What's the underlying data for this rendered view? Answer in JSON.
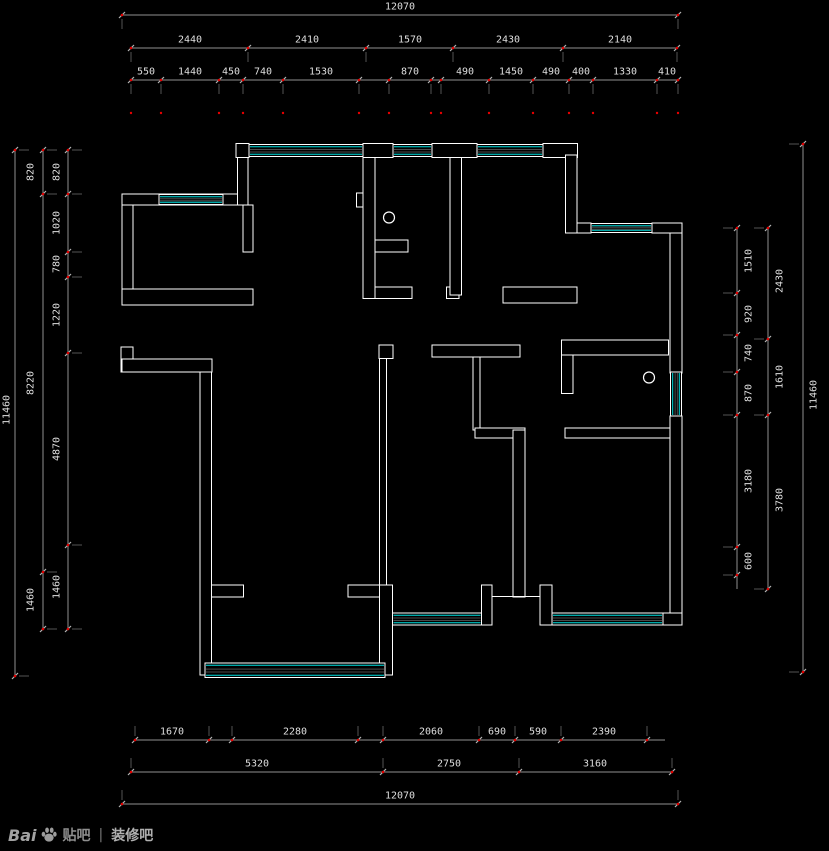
{
  "colors": {
    "background": "#000000",
    "wall": "#ffffff",
    "window": "#00e0e0",
    "window_hatch": "#4a4a4a",
    "dim_line": "#8f8f8f",
    "dim_tick": "#b5b5b5",
    "dim_text": "#dfdfdf",
    "red_dot": "#e60000",
    "watermark": "#9c9c9c"
  },
  "dimensions": {
    "top_overall": {
      "o": "h",
      "pos": 15,
      "from": 122,
      "to": 678,
      "ticks": [
        122,
        678
      ],
      "ext": 14,
      "label_off": -8,
      "segments": [
        {
          "v": "12070",
          "c": 400
        }
      ]
    },
    "top_rooms": {
      "o": "h",
      "pos": 48,
      "from": 131,
      "to": 677,
      "ticks": [
        131,
        248,
        366,
        453,
        563,
        677
      ],
      "ext": 14,
      "label_off": -8,
      "segments": [
        {
          "v": "2440",
          "c": 190
        },
        {
          "v": "2410",
          "c": 307
        },
        {
          "v": "1570",
          "c": 410
        },
        {
          "v": "2430",
          "c": 508
        },
        {
          "v": "2140",
          "c": 620
        }
      ]
    },
    "top_detail": {
      "o": "h",
      "pos": 80,
      "from": 131,
      "to": 678,
      "ticks": [
        131,
        161,
        219,
        243,
        283,
        359,
        389,
        431,
        441,
        489,
        533,
        569,
        593,
        657,
        678
      ],
      "ext": 14,
      "label_off": -8,
      "dot_row": 113,
      "segments": [
        {
          "v": "550",
          "c": 146
        },
        {
          "v": "1440",
          "c": 190
        },
        {
          "v": "450",
          "c": 231
        },
        {
          "v": "740",
          "c": 263
        },
        {
          "v": "1530",
          "c": 321
        },
        {
          "v": "870",
          "c": 410
        },
        {
          "v": "490",
          "c": 465
        },
        {
          "v": "1450",
          "c": 511
        },
        {
          "v": "490",
          "c": 551
        },
        {
          "v": "400",
          "c": 581
        },
        {
          "v": "1330",
          "c": 625
        },
        {
          "v": "410",
          "c": 667
        }
      ]
    },
    "bottom_detail": {
      "o": "h",
      "pos": 740,
      "from": 135,
      "to": 665,
      "ticks": [
        135,
        209,
        232,
        358,
        383,
        479,
        515,
        561,
        647
      ],
      "ext": -14,
      "label_off": -8,
      "segments": [
        {
          "v": "1670",
          "c": 172
        },
        {
          "v": "2280",
          "c": 295
        },
        {
          "v": "2060",
          "c": 431
        },
        {
          "v": "690",
          "c": 497
        },
        {
          "v": "590",
          "c": 538
        },
        {
          "v": "2390",
          "c": 604
        }
      ]
    },
    "bottom_rooms": {
      "o": "h",
      "pos": 772,
      "from": 131,
      "to": 672,
      "ticks": [
        131,
        383,
        519,
        672
      ],
      "ext": -14,
      "label_off": -8,
      "segments": [
        {
          "v": "5320",
          "c": 257
        },
        {
          "v": "2750",
          "c": 449
        },
        {
          "v": "3160",
          "c": 595
        }
      ]
    },
    "bottom_overall": {
      "o": "h",
      "pos": 804,
      "from": 122,
      "to": 678,
      "ticks": [
        122,
        678
      ],
      "ext": -14,
      "label_off": -8,
      "segments": [
        {
          "v": "12070",
          "c": 400
        }
      ]
    },
    "left_detail": {
      "o": "v",
      "pos": 68,
      "from": 150,
      "to": 629,
      "ticks": [
        150,
        194,
        252,
        277,
        353,
        545,
        629
      ],
      "ext": 14,
      "label_off": -11,
      "segments": [
        {
          "v": "820",
          "c": 172
        },
        {
          "v": "1020",
          "c": 223
        },
        {
          "v": "780",
          "c": 264
        },
        {
          "v": "1220",
          "c": 315
        },
        {
          "v": "4870",
          "c": 449
        },
        {
          "v": "1460",
          "c": 587
        }
      ]
    },
    "left_mid": {
      "o": "v",
      "pos": 43,
      "from": 150,
      "to": 629,
      "ticks": [
        150,
        194,
        572,
        629
      ],
      "ext": 14,
      "label_off": -12,
      "segments": [
        {
          "v": "820",
          "c": 172
        },
        {
          "v": "8220",
          "c": 383
        },
        {
          "v": "1460",
          "c": 600
        }
      ]
    },
    "left_overall": {
      "o": "v",
      "pos": 15,
      "from": 150,
      "to": 676,
      "ticks": [
        150,
        676
      ],
      "ext": 14,
      "label_off": -8,
      "segments": [
        {
          "v": "11460",
          "c": 410
        }
      ]
    },
    "right_detail": {
      "o": "v",
      "pos": 737,
      "from": 228,
      "to": 589,
      "ticks": [
        228,
        293,
        335,
        372,
        415,
        547,
        575
      ],
      "ext": -14,
      "label_off": 12,
      "segments": [
        {
          "v": "1510",
          "c": 261
        },
        {
          "v": "920",
          "c": 314
        },
        {
          "v": "740",
          "c": 353
        },
        {
          "v": "870",
          "c": 393
        },
        {
          "v": "3180",
          "c": 481
        },
        {
          "v": "600",
          "c": 561
        }
      ]
    },
    "right_mid": {
      "o": "v",
      "pos": 768,
      "from": 228,
      "to": 589,
      "ticks": [
        228,
        339,
        415,
        589
      ],
      "ext": -14,
      "label_off": 12,
      "segments": [
        {
          "v": "2430",
          "c": 281
        },
        {
          "v": "1610",
          "c": 377
        },
        {
          "v": "3780",
          "c": 500
        }
      ]
    },
    "right_overall": {
      "o": "v",
      "pos": 803,
      "from": 144,
      "to": 672,
      "ticks": [
        144,
        672
      ],
      "ext": -14,
      "label_off": 11,
      "segments": [
        {
          "v": "11460",
          "c": 395
        }
      ]
    }
  },
  "watermark": {
    "brand": "Bai",
    "tieba": "贴吧",
    "divider": "|",
    "forum": "装修吧"
  }
}
